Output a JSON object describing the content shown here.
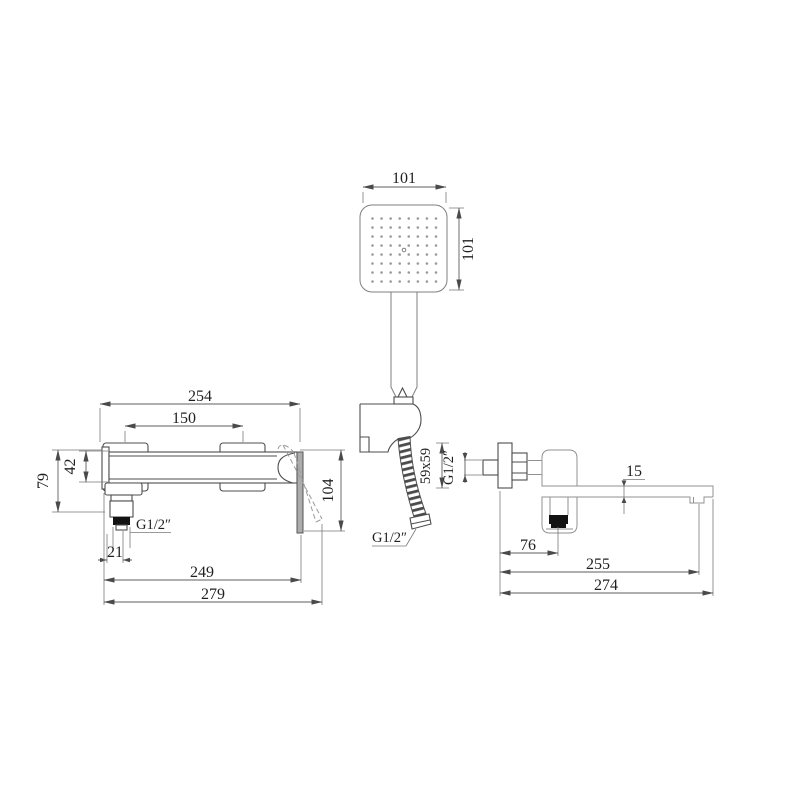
{
  "drawing_type": "faucet-set-dimension-drawing",
  "colors": {
    "background": "#ffffff",
    "line_dark": "#4d4d4d",
    "line_light": "#929292",
    "fill_black": "#121212",
    "fill_gray": "#acacac",
    "text": "#1f1f1f"
  },
  "hand_shower": {
    "dim_width": "101",
    "dim_height": "101",
    "hose_thread": "G1/2″",
    "spray_grid": {
      "rows": 8,
      "cols": 8
    }
  },
  "wall_mixer": {
    "dim_overall": "254",
    "dim_inlet_spacing": "150",
    "dim_body_height": "42",
    "dim_height_left": "79",
    "dim_handle_height": "104",
    "dim_outlet_offset": "21",
    "dim_length_249": "249",
    "dim_length_279": "279",
    "thread_outlet": "G1/2″"
  },
  "wall_spout": {
    "dim_flange": "59x59",
    "thread_inlet": "G1/2″",
    "dim_arm_thickness": "15",
    "dim_outlet_offset": "76",
    "dim_reach_255": "255",
    "dim_reach_274": "274"
  }
}
